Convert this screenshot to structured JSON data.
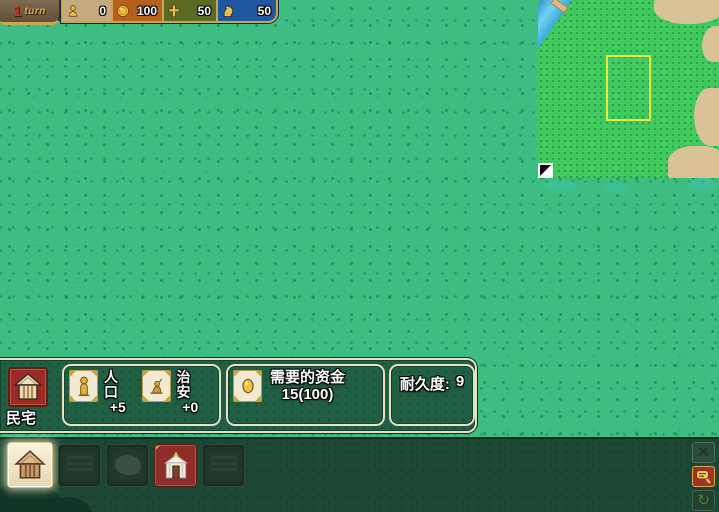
{
  "top_bar": {
    "turn_number": "1",
    "turn_label": "turn",
    "resources": [
      {
        "name": "population",
        "icon": "person-icon",
        "value": "0",
        "bg": "#c4aa7c"
      },
      {
        "name": "gold",
        "icon": "coin-icon",
        "value": "100",
        "bg": "#b5601f"
      },
      {
        "name": "faith",
        "icon": "cross-icon",
        "value": "50",
        "bg": "#5a6a22"
      },
      {
        "name": "military",
        "icon": "knight-icon",
        "value": "50",
        "bg": "#2058a0"
      }
    ]
  },
  "minimap": {
    "viewport_color": "#e6e93e",
    "map_color": "#40c95e",
    "terrain_color": "#d9c396",
    "water_color": "#5ec0e8",
    "handle_icon": "resize-handle-icon"
  },
  "info_panel": {
    "building_name": "民宅",
    "building_icon": "house-icon",
    "stats": [
      {
        "icon": "person-icon",
        "label": "人口",
        "value": "+5"
      },
      {
        "icon": "security-icon",
        "label": "治安",
        "value": "+0"
      }
    ],
    "cost_icon": "coin-icon",
    "cost_label": "需要的资金",
    "cost_value": "15(100)",
    "durability_label": "耐久度:",
    "durability_value": "9"
  },
  "toolbar": {
    "slots": [
      {
        "icon": "house-icon",
        "state": "selected"
      },
      {
        "icon": "building-icon",
        "state": "disabled"
      },
      {
        "icon": "rock-icon",
        "state": "disabled"
      },
      {
        "icon": "church-icon",
        "state": "available"
      },
      {
        "icon": "building-icon",
        "state": "disabled"
      }
    ],
    "side_buttons": [
      {
        "icon": "close-x-icon"
      },
      {
        "icon": "inspect-bubble-icon"
      },
      {
        "icon": "rotate-icon"
      }
    ]
  },
  "colors": {
    "field_green": "#3ebd82",
    "panel_green": "#215f44",
    "toolbar_green": "#1b4734",
    "cream_border": "#e9dfc2",
    "gold": "#c9a64f",
    "slot_red": "#8e2d2a"
  }
}
